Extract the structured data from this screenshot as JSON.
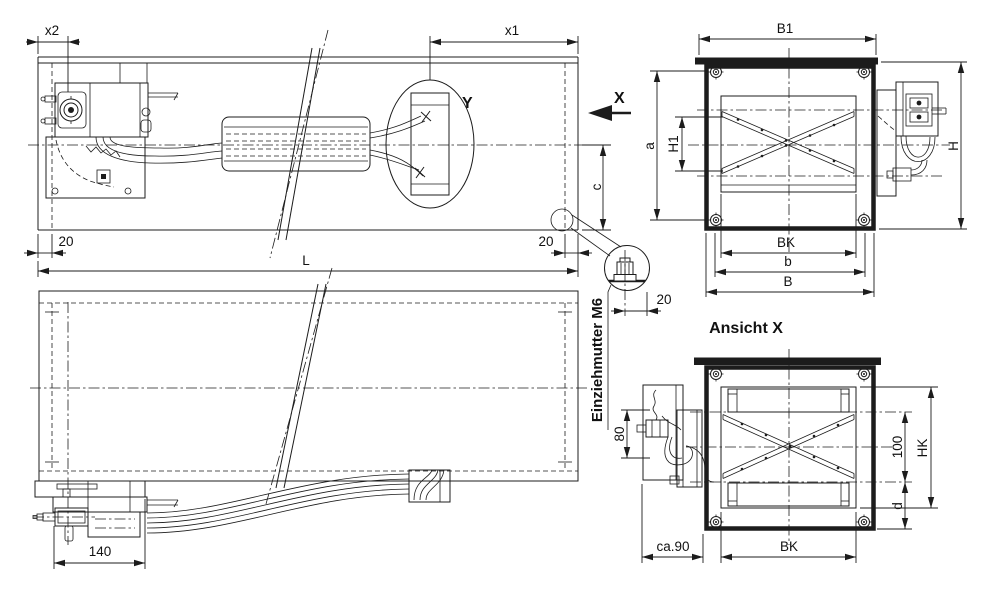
{
  "colors": {
    "background": "#ffffff",
    "line": "#1c1c1c"
  },
  "side_view": {
    "dim_x2": "x2",
    "dim_x1": "x1",
    "dim_20_left": "20",
    "dim_20_right": "20",
    "dim_length": "L",
    "dim_c": "c",
    "detail_label": "Y",
    "view_arrow_label": "X"
  },
  "front_view": {
    "dim_b1": "B1",
    "dim_a": "a",
    "dim_h1": "H1",
    "dim_h": "H",
    "dim_bk": "BK",
    "dim_b": "b",
    "dim_b_outer": "B"
  },
  "detail_view": {
    "note": "Einziehmutter M6",
    "dim_20": "20"
  },
  "top_view": {
    "dim_140": "140"
  },
  "view_x": {
    "heading": "Ansicht X",
    "dim_80": "80",
    "dim_100": "100",
    "dim_hk": "HK",
    "dim_d": "d",
    "dim_bk": "BK",
    "dim_ca90": "ca.90"
  }
}
